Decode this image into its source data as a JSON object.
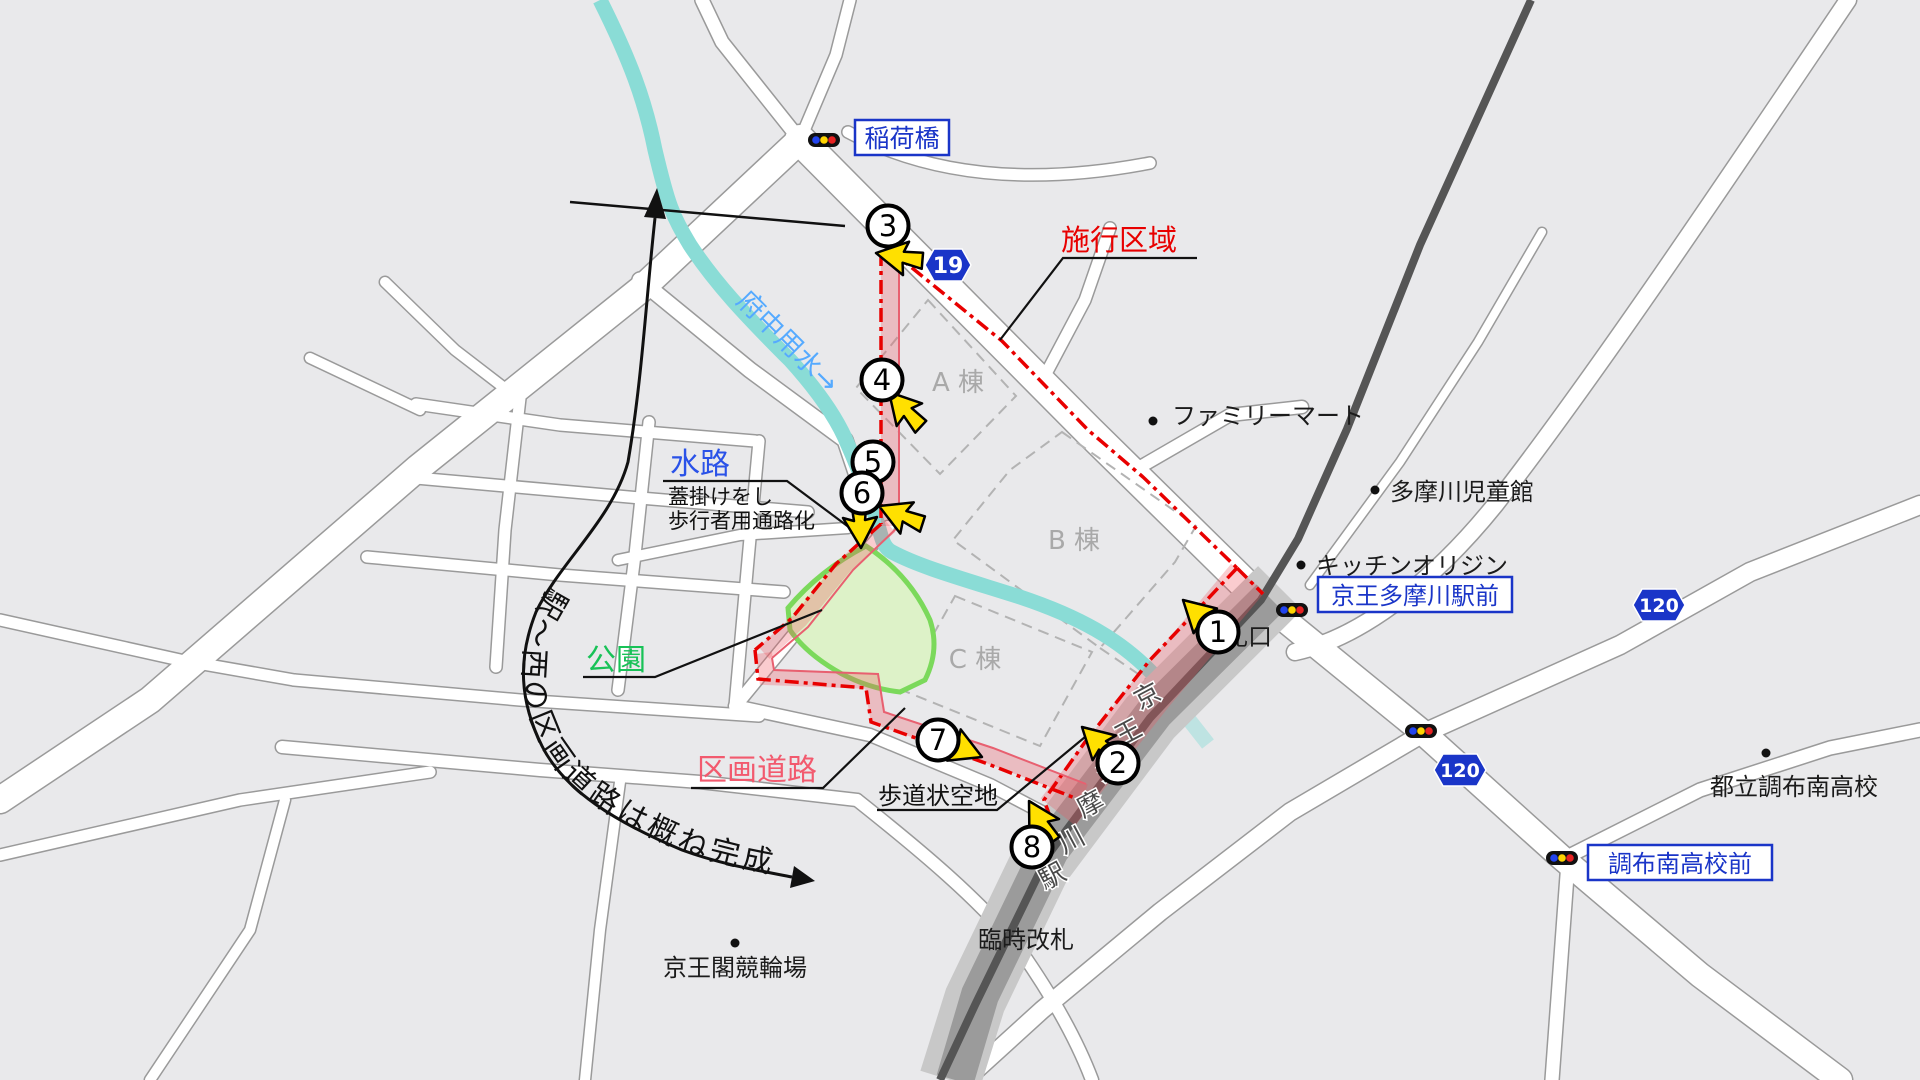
{
  "map": {
    "labels": {
      "inari_bridge": "稲荷橋",
      "construction_area": "施行区域",
      "fuchu_irrigation": "府中用水→",
      "waterway": "水路",
      "waterway_note_1": "蓋掛けをし",
      "waterway_note_2": "歩行者用通路化",
      "park": "公園",
      "district_road": "区画道路",
      "sidewalk_space": "歩道状空地",
      "curve_annotation": "駅～西の区画道路は概ね完成",
      "building_a": "A 棟",
      "building_b": "B 棟",
      "building_c": "C 棟",
      "familymart": "ファミリーマート",
      "tamagawa_childrens_hall": "多摩川児童館",
      "kitchen_origin": "キッチンオリジン",
      "station_front": "京王多摩川駅前",
      "ticket_gate": "改札口",
      "temporary_gate": "臨時改札",
      "keiokaku_velodrome": "京王閣競輪場",
      "chofu_minami_hs_front": "調布南高校前",
      "chofu_minami_hs": "都立調布南高校"
    },
    "station_name_chars": [
      "京",
      "王",
      "多",
      "摩",
      "川",
      "駅"
    ],
    "route_badges": {
      "r19": "19",
      "r120": "120"
    },
    "markers": [
      "1",
      "2",
      "3",
      "4",
      "5",
      "6",
      "7",
      "8"
    ],
    "colors": {
      "boundary_red": "#e80000",
      "corridor_pink": "#f2aab0",
      "park_border_green": "#7bd95b",
      "park_fill_green": "#ddf2c8",
      "water_teal": "#8adcd6",
      "water_label_blue": "#55aaff",
      "sign_blue": "#1a35c8",
      "district_road_pink": "#f25a6e",
      "park_label_green": "#18c257",
      "arrow_yellow": "#ffe000"
    }
  }
}
